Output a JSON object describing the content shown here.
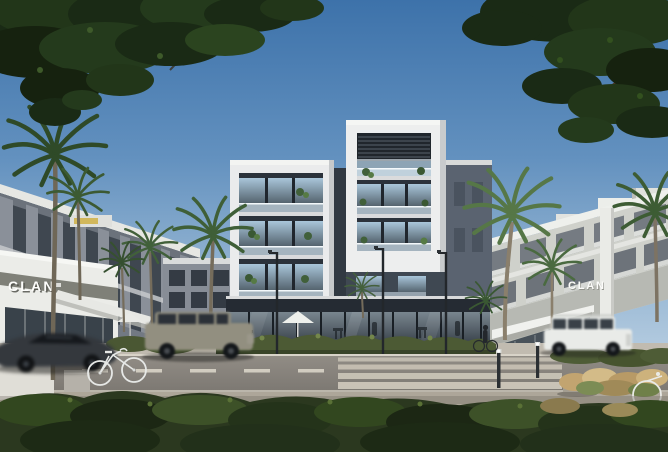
{
  "image": {
    "type": "architectural-exterior-render",
    "signs": {
      "left": "CLAN",
      "right": "CLAN"
    }
  },
  "palette": {
    "sky_top": "#3d72aa",
    "sky_horizon": "#c9dae8",
    "central_facade_dark": "#39424c",
    "facade_white_frame": "#eaebec",
    "left_buildings_grey": "#8a9099",
    "right_buildings_white": "#cfd1cb",
    "road": "#8f8a83",
    "sidewalk": "#c1bbb0",
    "crosswalk_stripe": "#ccc6b9",
    "hedge_green": "#4c5a34",
    "foreground_shrubs": "#2b381f",
    "tree_canopy": "#1d2c18",
    "palm_fronds": "#547548",
    "sports_car": "#34383d",
    "grey_suv": "#928f80",
    "white_suv": "#e9ebe8"
  },
  "objects": [
    "overhanging street trees",
    "palm trees",
    "four-storey apartment building",
    "rooftop pergola",
    "glass balconies with plants",
    "retail storefront with cafe",
    "white cafe umbrellas",
    "grey townhouse row",
    "white residential block",
    "CLAN signage",
    "asphalt road",
    "zebra crosswalk",
    "street lamps",
    "solar bollards",
    "concrete bench",
    "dark sports car",
    "grey suv",
    "white suv",
    "parked bicycles",
    "pedestrian with bicycle",
    "foreground shrubs",
    "planter with orange flowers",
    "ornamental grasses"
  ]
}
